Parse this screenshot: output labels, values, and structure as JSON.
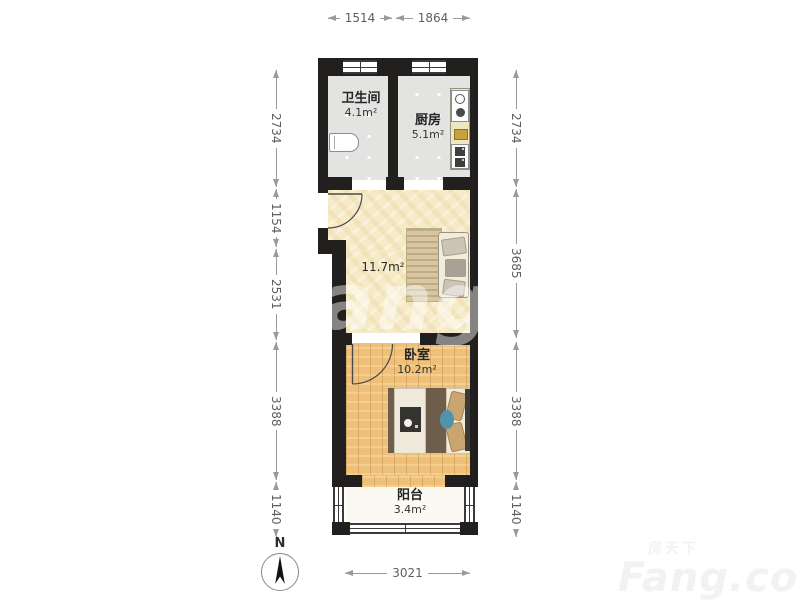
{
  "plan_title": "one-bedroom-apartment-floor-plan",
  "rooms": {
    "bathroom": {
      "name": "卫生间",
      "area": "4.1m²"
    },
    "kitchen": {
      "name": "厨房",
      "area": "5.1m²"
    },
    "living": {
      "area": "11.7m²"
    },
    "bedroom": {
      "name": "卧室",
      "area": "10.2m²"
    },
    "balcony": {
      "name": "阳台",
      "area": "3.4m²"
    }
  },
  "dimensions": {
    "top": [
      "1514",
      "1864"
    ],
    "left": [
      "2734",
      "1154",
      "2531",
      "3388",
      "1140"
    ],
    "right": [
      "2734",
      "3685",
      "3388",
      "1140"
    ],
    "bottom": [
      "3021"
    ]
  },
  "compass": {
    "label": "N"
  },
  "watermark": {
    "center": "fang.com",
    "brand_cn": "房天下",
    "brand_en": "Fang.com"
  },
  "colors": {
    "wall": "#21201e",
    "tile_floor": "#e3e3e1",
    "living_floor": "#f6ebc9",
    "wood_floor": "#eec07a",
    "balcony_floor": "#fbf9f1",
    "dimension": "#9a9a9a"
  }
}
